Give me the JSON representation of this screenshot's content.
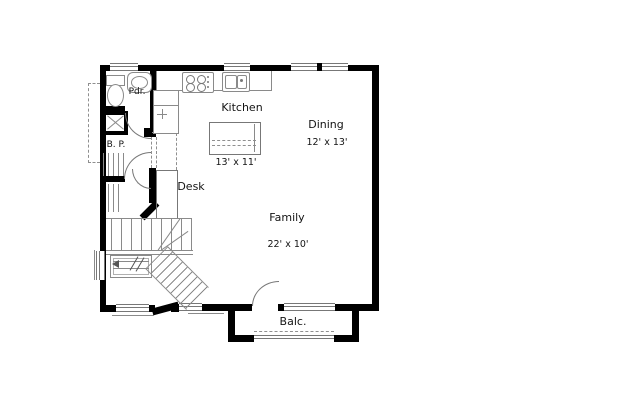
{
  "drawing": {
    "type": "floor-plan"
  },
  "rooms": {
    "powder": {
      "label": "Pdr."
    },
    "bp": {
      "label": "B. P."
    },
    "kitchen": {
      "label": "Kitchen",
      "dims": "13' x 11'"
    },
    "dining": {
      "label": "Dining",
      "dims": "12' x 13'"
    },
    "desk": {
      "label": "Desk"
    },
    "family": {
      "label": "Family",
      "dims": "22' x 10'"
    },
    "balcony": {
      "label": "Balc."
    }
  },
  "fixtures": [
    "toilet-icon",
    "vanity-sink-icon",
    "range-icon",
    "kitchen-sink-icon",
    "refrigerator-icon",
    "island-eating-bar",
    "stairs",
    "door-swing",
    "window",
    "balcony-railing",
    "shelving",
    "chase-x-box"
  ],
  "colors": {
    "wall": "#000000",
    "line": "#8a8a8a",
    "text": "#141414",
    "bg": "#ffffff"
  }
}
